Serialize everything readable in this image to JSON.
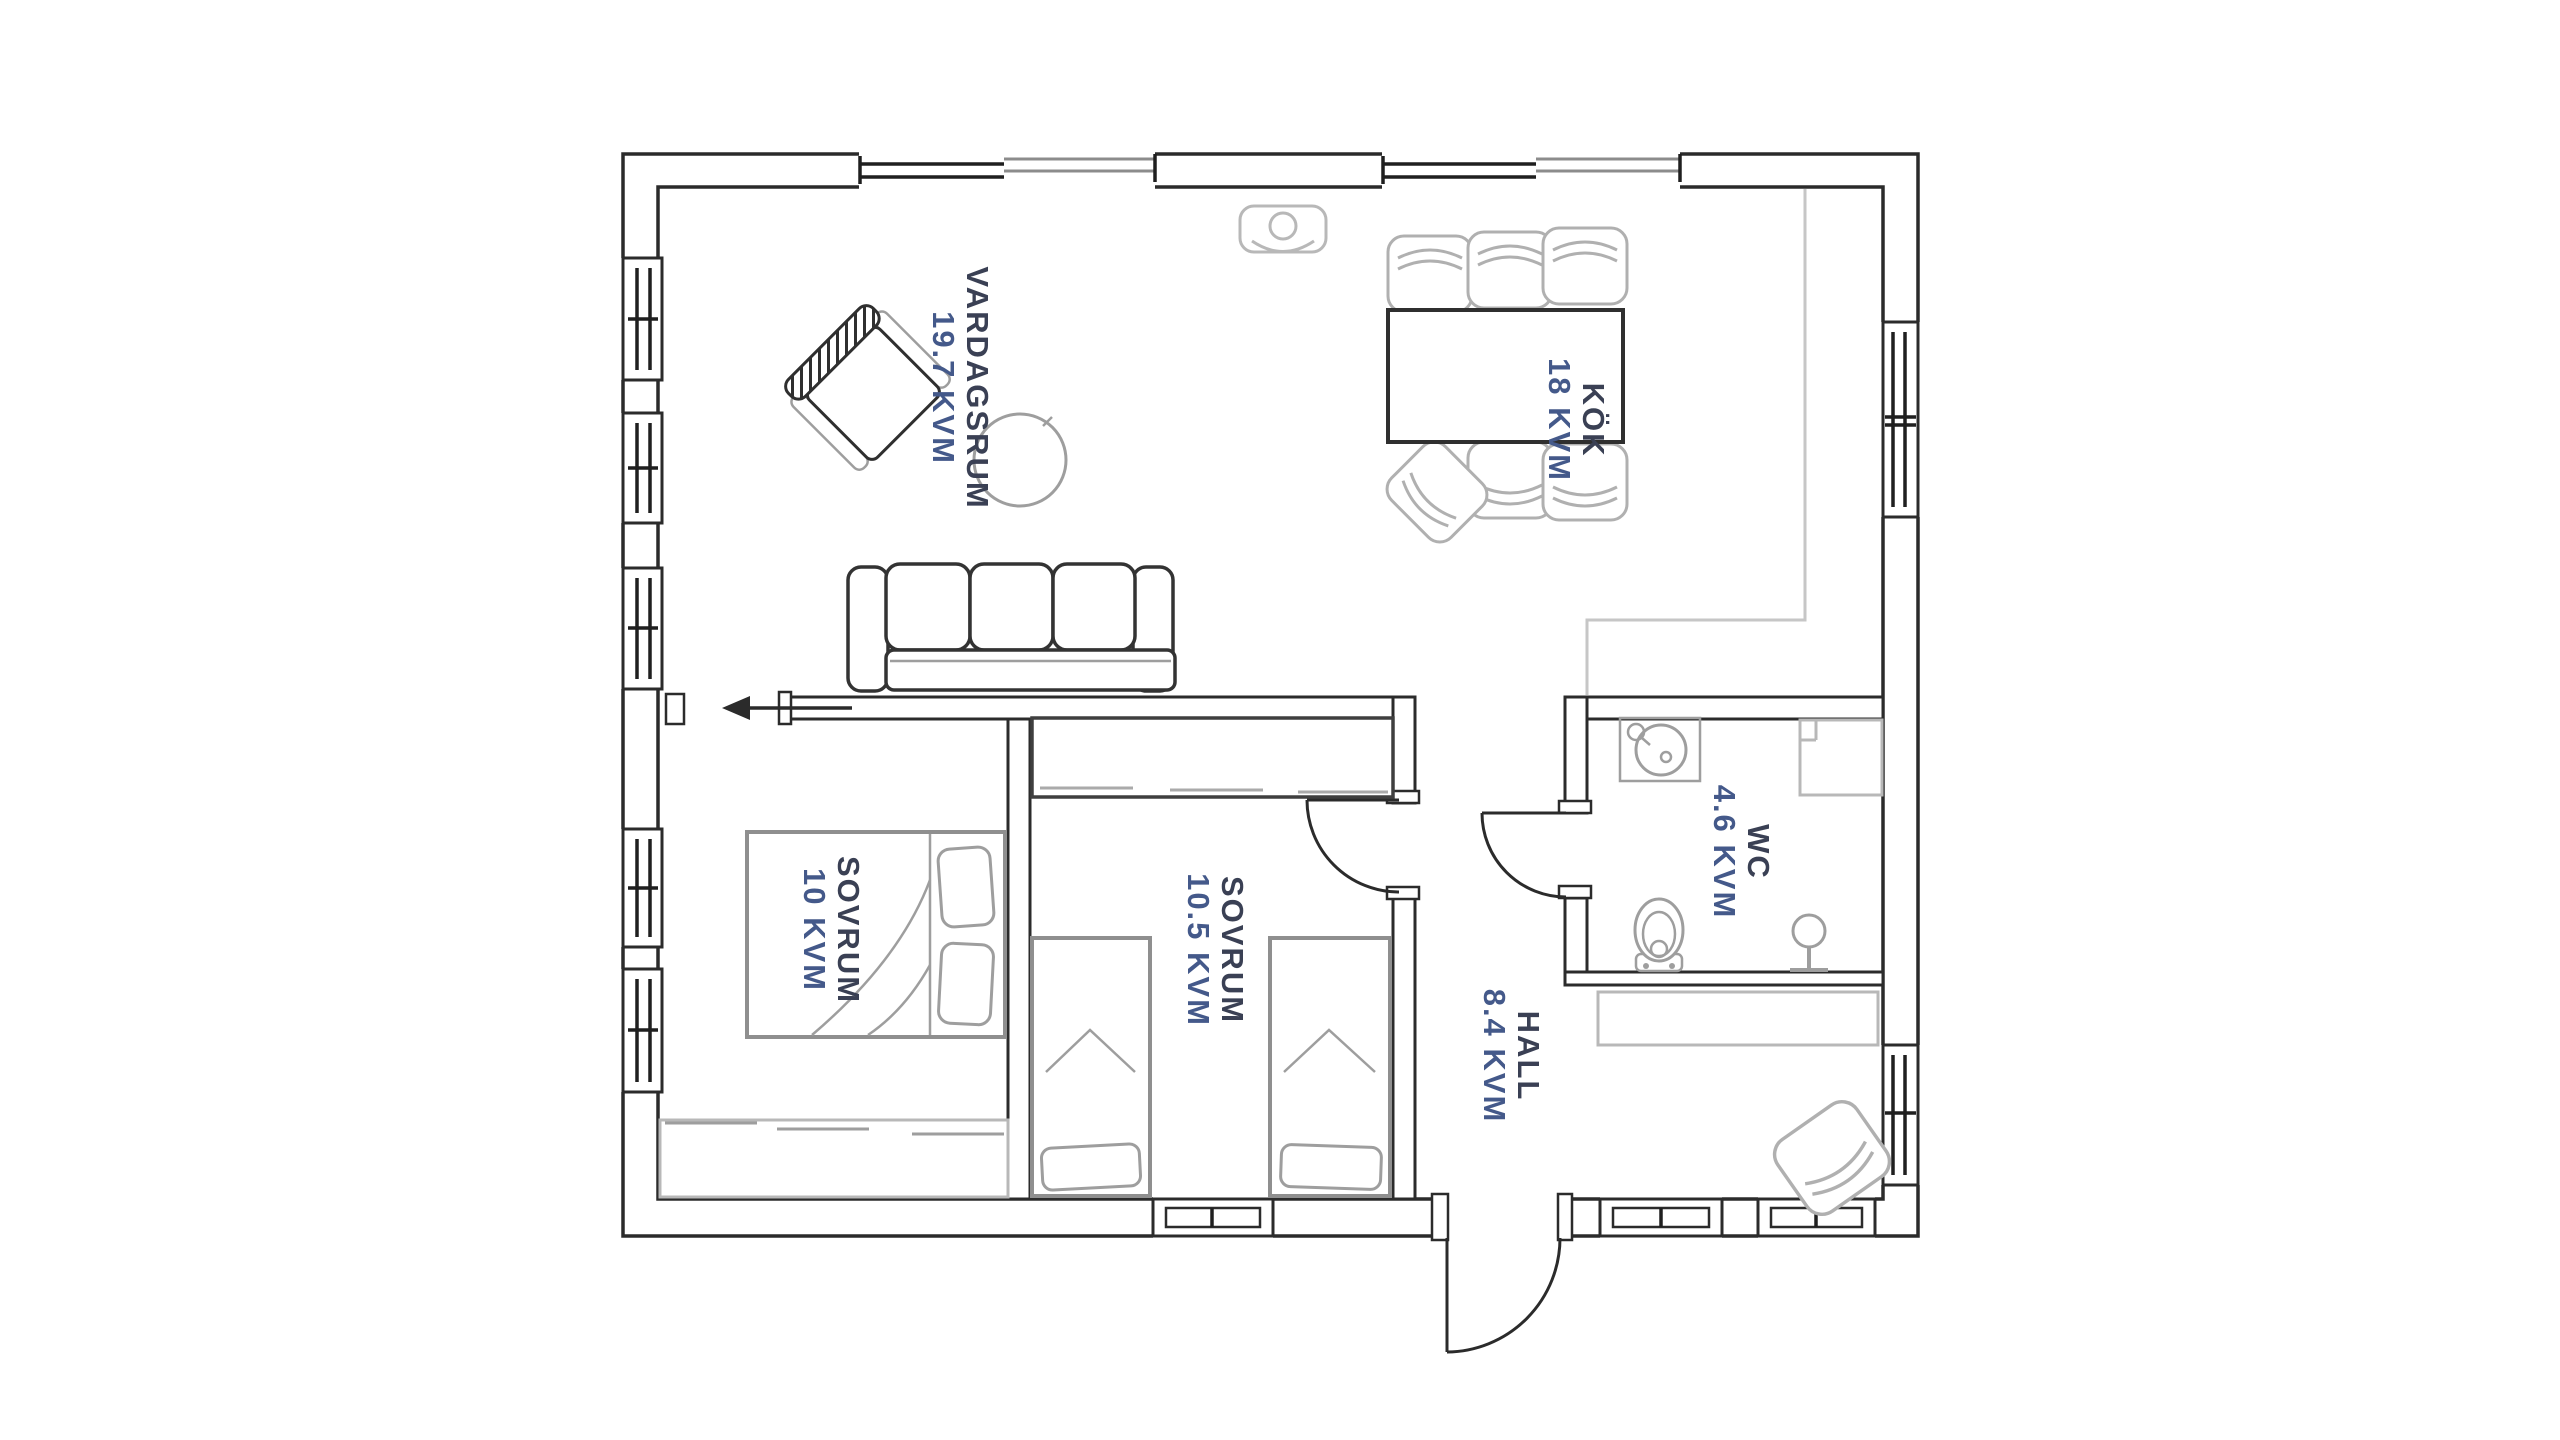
{
  "meta": {
    "document_type": "floor-plan",
    "language": "sv"
  },
  "colors": {
    "background": "#ffffff",
    "wall": "#2b2b2b",
    "furniture_gray": "#9e9e9e",
    "furniture_light": "#b8b8b8",
    "label_name": "#3a4054",
    "label_area": "#44598a"
  },
  "rooms": [
    {
      "id": "vardagsrum",
      "name": "VARDAGSRUM",
      "area": "19.7 KVM"
    },
    {
      "id": "kok",
      "name": "KÖK",
      "area": "18 KVM"
    },
    {
      "id": "sovrum-1",
      "name": "SOVRUM",
      "area": "10 KVM"
    },
    {
      "id": "sovrum-2",
      "name": "SOVRUM",
      "area": "10.5 KVM"
    },
    {
      "id": "wc",
      "name": "WC",
      "area": "4.6 KVM"
    },
    {
      "id": "hall",
      "name": "HALL",
      "area": "8.4 KVM"
    }
  ],
  "icons": [
    "sofa-icon",
    "armchair-icon",
    "round-table-icon",
    "ceiling-lamp-icon",
    "dining-table-icon",
    "chair-icon",
    "double-bed-icon",
    "single-bed-icon",
    "wardrobe-icon",
    "sink-icon",
    "toilet-icon",
    "towel-stand-icon",
    "kitchen-counter-icon",
    "entrance-arrow-icon",
    "door-swing-icon",
    "window-icon"
  ]
}
